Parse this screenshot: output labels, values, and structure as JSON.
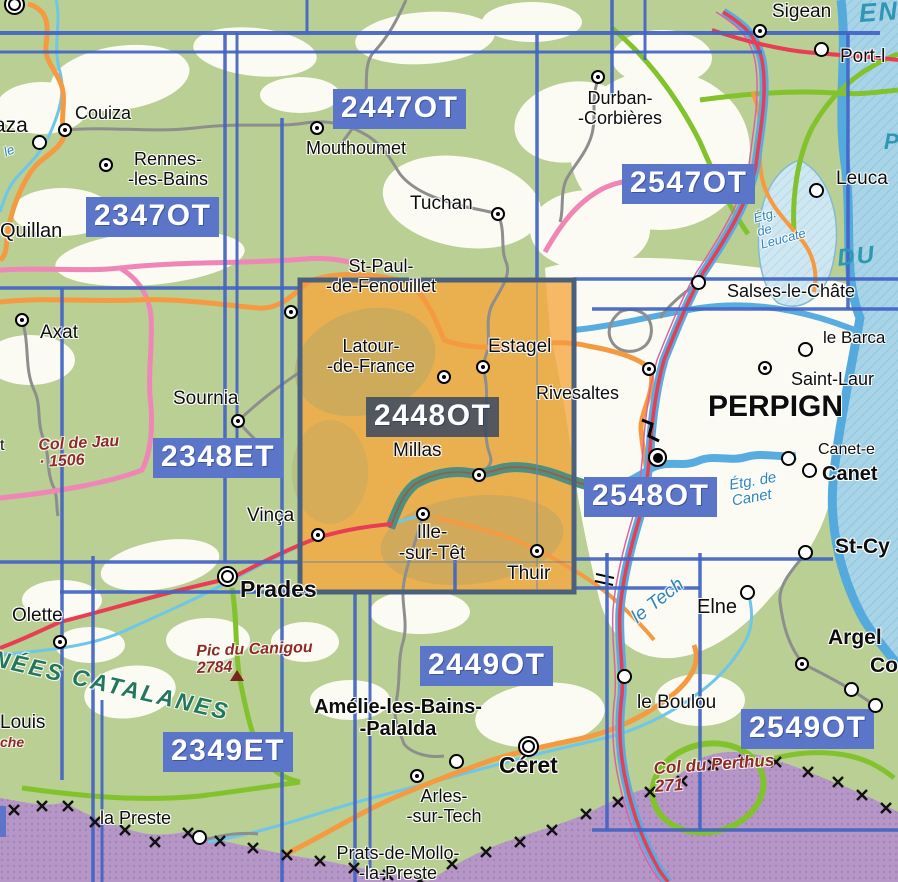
{
  "map": {
    "description": "IGN France map sheet index, Pyrenees-Orientales / Perpignan area",
    "selected_sheet": "2448OT",
    "colors": {
      "sheet_grid_blue": "#4164c2",
      "badge_blue": "#5b76c8",
      "selected_badge_dark": "#384661",
      "selected_sheet_orange": "#f7a73d",
      "land_green": "#b9cf93",
      "plain_white": "#fbfbf3",
      "sea_blue": "#a9d4e8",
      "coast_blue": "#54aadd",
      "spain_purple": "#b596c6",
      "motorway_red": "#e83d52",
      "road_orange": "#f59a40",
      "road_pink": "#ef86b6",
      "road_green": "#82c32d",
      "river_cyan": "#6ec6e8",
      "expressway_teal": "#4e8f7d",
      "water_label_blue": "#2f86ba",
      "relief_label_red": "#8e2a24",
      "range_label_green": "#23785c"
    },
    "sheet_badges": [
      {
        "code": "2347OT",
        "x": 86,
        "y": 197,
        "variant": "blue"
      },
      {
        "code": "2447OT",
        "x": 333,
        "y": 89,
        "variant": "blue"
      },
      {
        "code": "2547OT",
        "x": 622,
        "y": 164,
        "variant": "blue"
      },
      {
        "code": "2348ET",
        "x": 153,
        "y": 438,
        "variant": "blue"
      },
      {
        "code": "2448OT",
        "x": 366,
        "y": 397,
        "variant": "dark"
      },
      {
        "code": "2548OT",
        "x": 584,
        "y": 477,
        "variant": "blue"
      },
      {
        "code": "2449OT",
        "x": 420,
        "y": 646,
        "variant": "blue"
      },
      {
        "code": "2549OT",
        "x": 741,
        "y": 709,
        "variant": "blue"
      },
      {
        "code": "2349ET",
        "x": 163,
        "y": 732,
        "variant": "blue"
      },
      {
        "code": "T",
        "x": -22,
        "y": 806,
        "variant": "fragment"
      }
    ],
    "towns": [
      {
        "lines": [
          "Couiza"
        ],
        "x": 75,
        "y": 103,
        "size": 18
      },
      {
        "lines": [
          "Rennes-",
          "-les-Bains"
        ],
        "x": 168,
        "y": 149,
        "size": 18,
        "center": true
      },
      {
        "lines": [
          "Quillan"
        ],
        "x": 0,
        "y": 220,
        "size": 20
      },
      {
        "lines": [
          "aza"
        ],
        "x": -6,
        "y": 114,
        "size": 21
      },
      {
        "lines": [
          "Mouthoumet"
        ],
        "x": 306,
        "y": 138,
        "size": 18
      },
      {
        "lines": [
          "Tuchan"
        ],
        "x": 410,
        "y": 193,
        "size": 19
      },
      {
        "lines": [
          "Durban-",
          "-Corbières"
        ],
        "x": 620,
        "y": 88,
        "size": 18,
        "center": true
      },
      {
        "lines": [
          "Sigean"
        ],
        "x": 772,
        "y": 1,
        "size": 19
      },
      {
        "lines": [
          "Port-l"
        ],
        "x": 840,
        "y": 46,
        "size": 19
      },
      {
        "lines": [
          "Leuca"
        ],
        "x": 836,
        "y": 168,
        "size": 19
      },
      {
        "lines": [
          "Salses-le-Châte"
        ],
        "x": 727,
        "y": 281,
        "size": 18
      },
      {
        "lines": [
          "le Barca"
        ],
        "x": 823,
        "y": 328,
        "size": 17
      },
      {
        "lines": [
          "Saint-Laur"
        ],
        "x": 791,
        "y": 369,
        "size": 18
      },
      {
        "lines": [
          "PERPIGN"
        ],
        "x": 708,
        "y": 390,
        "size": 30,
        "bold": true
      },
      {
        "lines": [
          "Canet-e"
        ],
        "x": 818,
        "y": 441,
        "size": 16
      },
      {
        "lines": [
          "Canet"
        ],
        "x": 822,
        "y": 463,
        "size": 20,
        "bold": true
      },
      {
        "lines": [
          "St-Cy"
        ],
        "x": 835,
        "y": 535,
        "size": 21,
        "bold": true
      },
      {
        "lines": [
          "Elne"
        ],
        "x": 697,
        "y": 596,
        "size": 20
      },
      {
        "lines": [
          "Argel"
        ],
        "x": 828,
        "y": 626,
        "size": 21,
        "bold": true
      },
      {
        "lines": [
          "Co"
        ],
        "x": 870,
        "y": 654,
        "size": 21,
        "bold": true
      },
      {
        "lines": [
          "le Boulou"
        ],
        "x": 637,
        "y": 692,
        "size": 19
      },
      {
        "lines": [
          "Axat"
        ],
        "x": 40,
        "y": 322,
        "size": 19
      },
      {
        "lines": [
          "Sournia"
        ],
        "x": 173,
        "y": 388,
        "size": 19
      },
      {
        "lines": [
          "St-Paul-",
          "-de-Fenouillet"
        ],
        "x": 381,
        "y": 256,
        "size": 18,
        "center": true
      },
      {
        "lines": [
          "Latour-",
          "-de-France"
        ],
        "x": 371,
        "y": 336,
        "size": 18,
        "center": true
      },
      {
        "lines": [
          "Estagel"
        ],
        "x": 488,
        "y": 336,
        "size": 19
      },
      {
        "lines": [
          "Rivesaltes"
        ],
        "x": 536,
        "y": 383,
        "size": 18
      },
      {
        "lines": [
          "Millas"
        ],
        "x": 393,
        "y": 440,
        "size": 19
      },
      {
        "lines": [
          "Ille-",
          "-sur-Têt"
        ],
        "x": 432,
        "y": 522,
        "size": 19,
        "center": true
      },
      {
        "lines": [
          "Thuir"
        ],
        "x": 507,
        "y": 563,
        "size": 19
      },
      {
        "lines": [
          "Vinça"
        ],
        "x": 247,
        "y": 505,
        "size": 19
      },
      {
        "lines": [
          "Prades"
        ],
        "x": 240,
        "y": 577,
        "size": 23,
        "bold": true
      },
      {
        "lines": [
          "Olette"
        ],
        "x": 12,
        "y": 605,
        "size": 19
      },
      {
        "lines": [
          "Louis"
        ],
        "x": 0,
        "y": 712,
        "size": 19
      },
      {
        "lines": [
          "Amélie-les-Bains-",
          "-Palalda"
        ],
        "x": 398,
        "y": 696,
        "size": 20,
        "bold": true,
        "center": true
      },
      {
        "lines": [
          "Céret"
        ],
        "x": 499,
        "y": 753,
        "size": 23,
        "bold": true
      },
      {
        "lines": [
          "Arles-",
          "-sur-Tech"
        ],
        "x": 444,
        "y": 786,
        "size": 18,
        "center": true
      },
      {
        "lines": [
          "Prats-de-Mollo-",
          "-la-Preste"
        ],
        "x": 398,
        "y": 843,
        "size": 18,
        "center": true
      },
      {
        "lines": [
          "la Preste"
        ],
        "x": 100,
        "y": 808,
        "size": 18
      },
      {
        "lines": [
          "t"
        ],
        "x": 0,
        "y": 437,
        "size": 16
      }
    ],
    "nature_labels": [
      {
        "lines": [
          "NÉES CATALANES"
        ],
        "x": -4,
        "y": 646,
        "cls": "green",
        "size": 23,
        "rotate": 13,
        "spacing": 2.5
      },
      {
        "lines": [
          "Pic du Canigou",
          "2784"
        ],
        "x": 196,
        "y": 644,
        "cls": "darkred",
        "size": 16,
        "rotate": -2
      },
      {
        "lines": [
          "Col de Jau",
          "·  1506"
        ],
        "x": 38,
        "y": 438,
        "cls": "darkred",
        "size": 16,
        "rotate": -3
      },
      {
        "lines": [
          "Col du Perthus",
          "271"
        ],
        "x": 653,
        "y": 760,
        "cls": "darkred",
        "size": 17,
        "rotate": -4
      },
      {
        "lines": [
          "che"
        ],
        "x": 0,
        "y": 735,
        "cls": "darkred",
        "size": 14,
        "rotate": 0
      },
      {
        "lines": [
          "le Tech"
        ],
        "x": 628,
        "y": 612,
        "cls": "water",
        "size": 19,
        "rotate": -38
      },
      {
        "lines": [
          "Étg. de",
          "Canet"
        ],
        "x": 728,
        "y": 478,
        "cls": "water",
        "size": 15,
        "rotate": -10
      },
      {
        "lines": [
          "Étg.",
          "de",
          "Leucate"
        ],
        "x": 752,
        "y": 212,
        "cls": "water",
        "size": 13,
        "rotate": -15
      },
      {
        "lines": [
          "DU"
        ],
        "x": 836,
        "y": 246,
        "cls": "sea",
        "size": 24,
        "rotate": -6,
        "spacing": 2
      },
      {
        "lines": [
          "EN"
        ],
        "x": 858,
        "y": 0,
        "cls": "sea",
        "size": 26,
        "rotate": -4,
        "spacing": 2
      },
      {
        "lines": [
          "P"
        ],
        "x": 884,
        "y": 130,
        "cls": "sea",
        "size": 22,
        "rotate": 0
      },
      {
        "lines": [
          "le"
        ],
        "x": 2,
        "y": 146,
        "cls": "water",
        "size": 13,
        "rotate": -20
      }
    ],
    "markers": [
      {
        "type": "double",
        "x": 15,
        "y": 5
      },
      {
        "type": "dot",
        "x": 65,
        "y": 130
      },
      {
        "type": "dot",
        "x": 106,
        "y": 165
      },
      {
        "type": "ring",
        "x": 40,
        "y": 143
      },
      {
        "type": "dot",
        "x": 317,
        "y": 128
      },
      {
        "type": "dot",
        "x": 498,
        "y": 214
      },
      {
        "type": "dot",
        "x": 598,
        "y": 77
      },
      {
        "type": "dot",
        "x": 760,
        "y": 31
      },
      {
        "type": "ring",
        "x": 822,
        "y": 50
      },
      {
        "type": "ring",
        "x": 817,
        "y": 191
      },
      {
        "type": "ring",
        "x": 699,
        "y": 283
      },
      {
        "type": "ring",
        "x": 806,
        "y": 350
      },
      {
        "type": "dot",
        "x": 765,
        "y": 368
      },
      {
        "type": "city",
        "x": 658,
        "y": 458
      },
      {
        "type": "ring",
        "x": 789,
        "y": 459
      },
      {
        "type": "ring",
        "x": 810,
        "y": 471
      },
      {
        "type": "ring",
        "x": 806,
        "y": 553
      },
      {
        "type": "ring",
        "x": 748,
        "y": 593
      },
      {
        "type": "dot",
        "x": 802,
        "y": 664
      },
      {
        "type": "ring",
        "x": 852,
        "y": 690
      },
      {
        "type": "ring",
        "x": 876,
        "y": 706
      },
      {
        "type": "ring",
        "x": 625,
        "y": 677
      },
      {
        "type": "dot",
        "x": 22,
        "y": 320
      },
      {
        "type": "dot",
        "x": 238,
        "y": 421
      },
      {
        "type": "dot",
        "x": 291,
        "y": 312
      },
      {
        "type": "dot",
        "x": 444,
        "y": 377
      },
      {
        "type": "dot",
        "x": 483,
        "y": 367
      },
      {
        "type": "dot",
        "x": 649,
        "y": 369
      },
      {
        "type": "dot",
        "x": 479,
        "y": 475
      },
      {
        "type": "dot",
        "x": 423,
        "y": 514
      },
      {
        "type": "dot",
        "x": 537,
        "y": 551
      },
      {
        "type": "dot",
        "x": 318,
        "y": 535
      },
      {
        "type": "double",
        "x": 228,
        "y": 577
      },
      {
        "type": "dot",
        "x": 60,
        "y": 642
      },
      {
        "type": "double",
        "x": 529,
        "y": 747
      },
      {
        "type": "dot",
        "x": 417,
        "y": 776
      },
      {
        "type": "ring",
        "x": 457,
        "y": 762
      },
      {
        "type": "ring",
        "x": 200,
        "y": 838
      },
      {
        "type": "peak",
        "x": 237,
        "y": 678
      }
    ]
  }
}
